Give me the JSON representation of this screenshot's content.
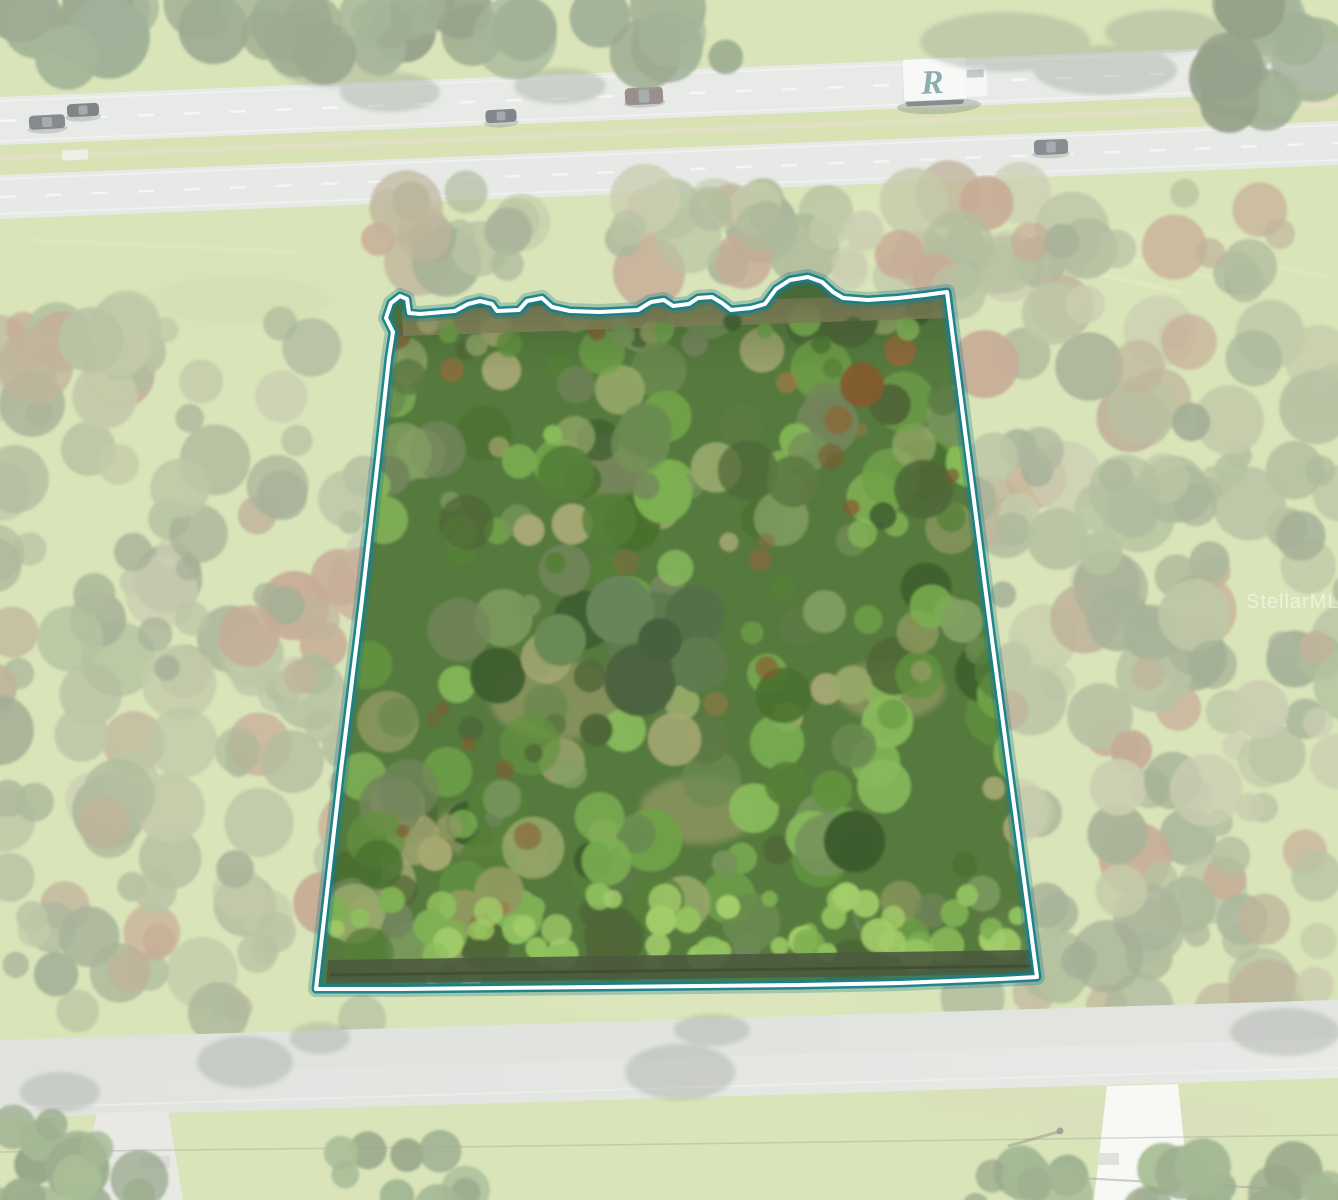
{
  "scene": {
    "type": "aerial-real-estate-photo",
    "description": "Drone aerial photo of a wooded vacant land parcel highlighted with a teal-and-white boundary outline, divided highway with traffic at top, two-lane street with driveways at bottom",
    "width": 1338,
    "height": 1200
  },
  "watermark": {
    "text": "StellarMLS",
    "color": "#ffffff",
    "opacity": 0.5
  },
  "truck": {
    "logo": "R"
  },
  "parcel": {
    "polygon": "393,332 386,318 391,303 400,296 407,299 409,313 420,314 455,311 468,304 480,301 492,304 497,311 519,310 527,301 542,298 552,307 570,311 600,312 638,310 651,302 664,300 673,306 689,304 698,298 712,297 722,303 731,310 751,308 765,304 776,289 790,280 808,277 822,282 833,292 843,298 868,300 898,298 925,295 947,292 992,640 1037,977 1000,979 900,983 800,985 700,986 600,987 500,988 400,989 316,989 341,770 362,600 377,468 389,358",
    "halo_color": "#187f8b",
    "core_color": "#ffffff",
    "wash_color": "#ffffff",
    "wash_opacity": 0.44
  },
  "palette": {
    "grass": "#bccf82",
    "grass_light": "#cdd996",
    "road_upper": "#d7dad4",
    "road_lower": "#d4d8d2",
    "street": "#ced2cb",
    "street_dark": "#c6cac3",
    "parcel_base": "#567a3e",
    "woods": [
      "#6f854f",
      "#7d9458",
      "#64784a",
      "#8a9c63",
      "#97a368",
      "#768b55",
      "#5d7245",
      "#a3a876",
      "#8f7a4e",
      "#9b6b45",
      "#82955e",
      "#6b8050"
    ],
    "top_trees": [
      "#4d683a",
      "#587548",
      "#43592f",
      "#5f7c4a",
      "#516b3d"
    ],
    "parcel_foliage": [
      "#3d5c2e",
      "#49702f",
      "#557f38",
      "#62923f",
      "#6fa148",
      "#7cb052",
      "#89bb5b",
      "#5d7a44",
      "#4e6637",
      "#75935a",
      "#83a062",
      "#6b8a50",
      "#96a96a",
      "#8f9a60",
      "#72855c",
      "#a5a872"
    ],
    "parcel_accents": [
      "#8a6a3c",
      "#9c7a45",
      "#7a5a30",
      "#86592f"
    ],
    "hedge": [
      "#7fb052",
      "#8fc05e",
      "#a3cc6a",
      "#93c25e"
    ],
    "bottom_trees": [
      "#4e7038",
      "#5c8242",
      "#6a9149",
      "#46622f"
    ]
  },
  "vehicles": [
    {
      "name": "car-sedan-dark-left-1",
      "x": 47,
      "y": 122,
      "w": 36,
      "h": 14,
      "color": "#262f34",
      "angle": -3
    },
    {
      "name": "car-sedan-dark-left-2",
      "x": 83,
      "y": 110,
      "w": 32,
      "h": 13,
      "color": "#1f262b",
      "angle": -3
    },
    {
      "name": "car-sedan-dark-mid",
      "x": 501,
      "y": 116,
      "w": 31,
      "h": 13,
      "color": "#20272e",
      "angle": -3
    },
    {
      "name": "suv-brown",
      "x": 644,
      "y": 96,
      "w": 38,
      "h": 17,
      "color": "#4a3832",
      "angle": -3
    },
    {
      "name": "car-sedan-dark-right",
      "x": 1051,
      "y": 147,
      "w": 34,
      "h": 15,
      "color": "#2e343b",
      "angle": -2
    }
  ]
}
